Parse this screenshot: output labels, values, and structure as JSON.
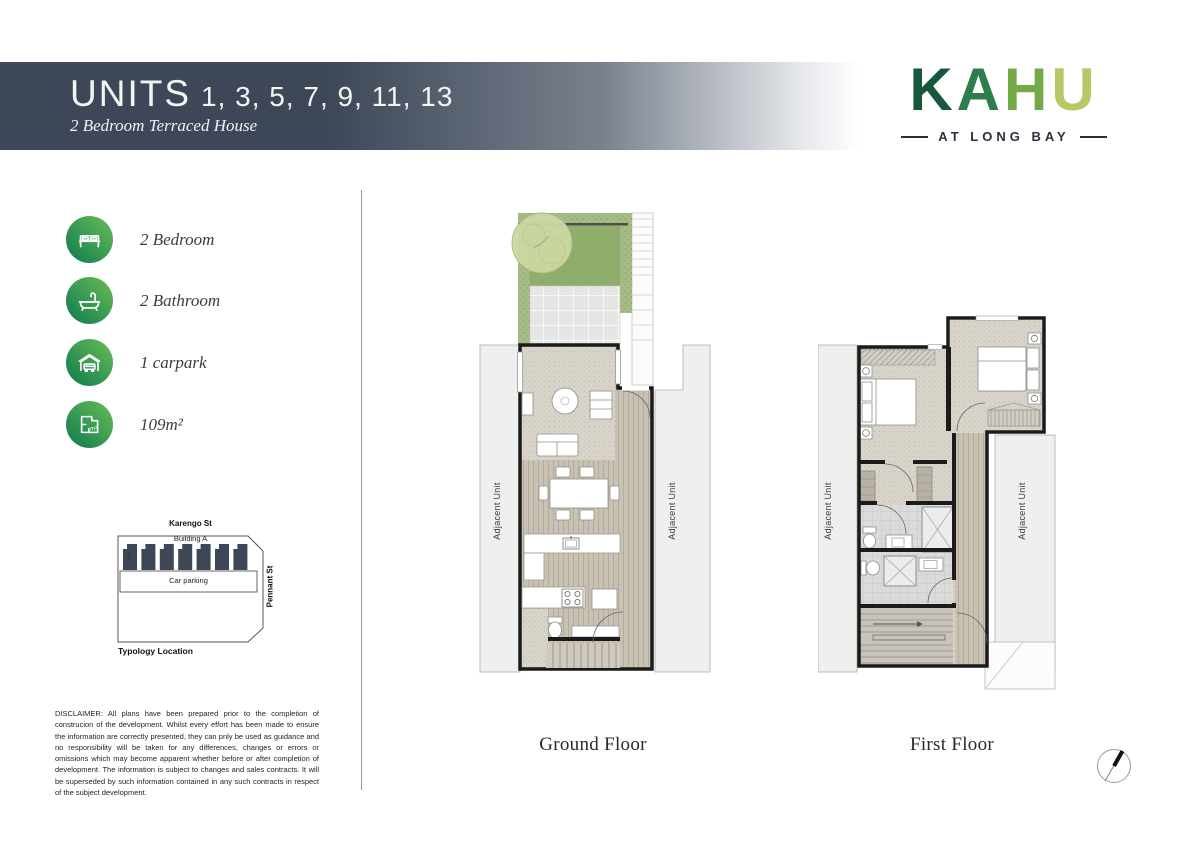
{
  "header": {
    "title": "UNITS",
    "units_list": "1, 3, 5, 7, 9, 11, 13",
    "subtitle": "2 Bedroom Terraced House"
  },
  "logo": {
    "letters": [
      "K",
      "A",
      "H",
      "U"
    ],
    "letter_colors": [
      "#17583c",
      "#2f7d4c",
      "#74a948",
      "#b9c766"
    ],
    "tagline": "AT LONG BAY"
  },
  "amenities": [
    {
      "icon": "bed-icon",
      "label": "2 Bedroom"
    },
    {
      "icon": "bathtub-icon",
      "label": "2 Bathroom"
    },
    {
      "icon": "garage-icon",
      "label": "1 carpark"
    },
    {
      "icon": "area-icon",
      "label": "109m²"
    }
  ],
  "typology": {
    "street_top": "Karengo St",
    "building_label": "Building A",
    "sim_label": "Sim",
    "car_parking_label": "Car parking",
    "street_right": "Pennant St",
    "caption": "Typology Location",
    "unit_count": 7
  },
  "disclaimer": "DISCLAIMER: All plans have been prepared prior to the completion of construcion of the development. Whilst every effort has been made to ensure the information are correctly presented, they can pnly be used as guidance and no responsibility will be taken for any differences, changes or errors or omissions which may become apparent whether before or after completion of development. The information is subject to changes and sales contracts. It will be superseded by such information contained in any such contracts in respect of the subject development.",
  "plans": {
    "ground": {
      "label": "Ground Floor"
    },
    "first": {
      "label": "First Floor"
    },
    "adjacent_unit_label": "Adjacent Unit"
  },
  "colors": {
    "banner": "#3d4757",
    "green_dark": "#0d7a4e",
    "green_light": "#6abd57",
    "slate_units": "#3d4757"
  }
}
